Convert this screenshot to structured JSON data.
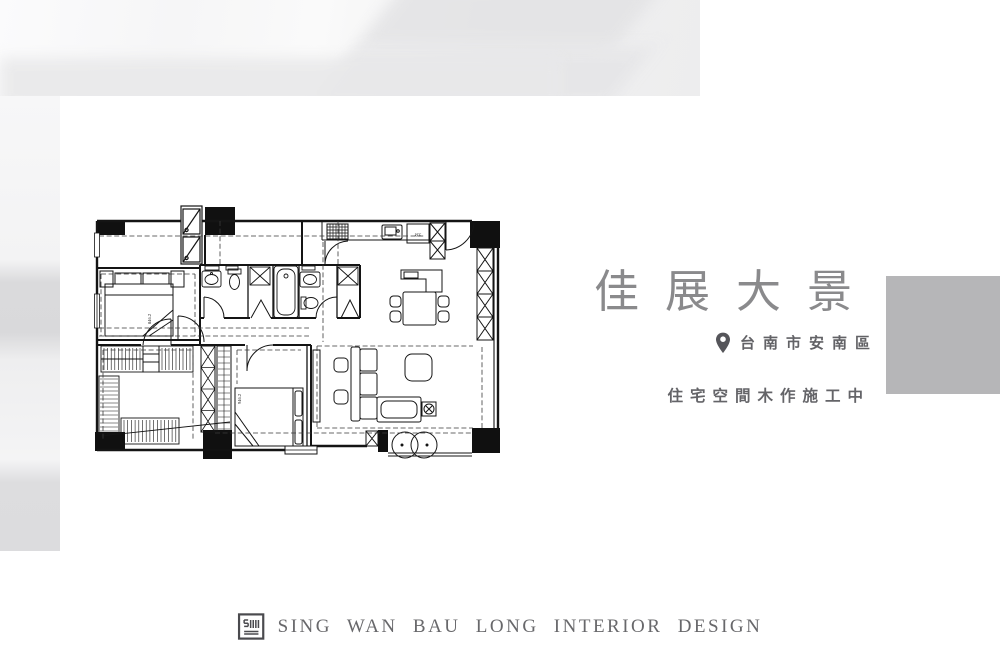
{
  "brand": {
    "title": "佳展大景",
    "location": "台南市安南區",
    "subtitle": "住宅空間木作施工中"
  },
  "footer": {
    "company": "SING WAN BAU LONG INTERIOR DESIGN"
  },
  "floor_plan": {
    "labels": {
      "fridge": "REF.",
      "master_bed_dim": "846.2",
      "second_bed_dim": "946.2"
    }
  },
  "colors": {
    "title_gray": "#8a8a8c",
    "text_gray": "#646468",
    "footer_gray": "#68686b",
    "accent_square": "#b6b6b8",
    "pin": "#55555a",
    "plan_line": "#141414"
  }
}
